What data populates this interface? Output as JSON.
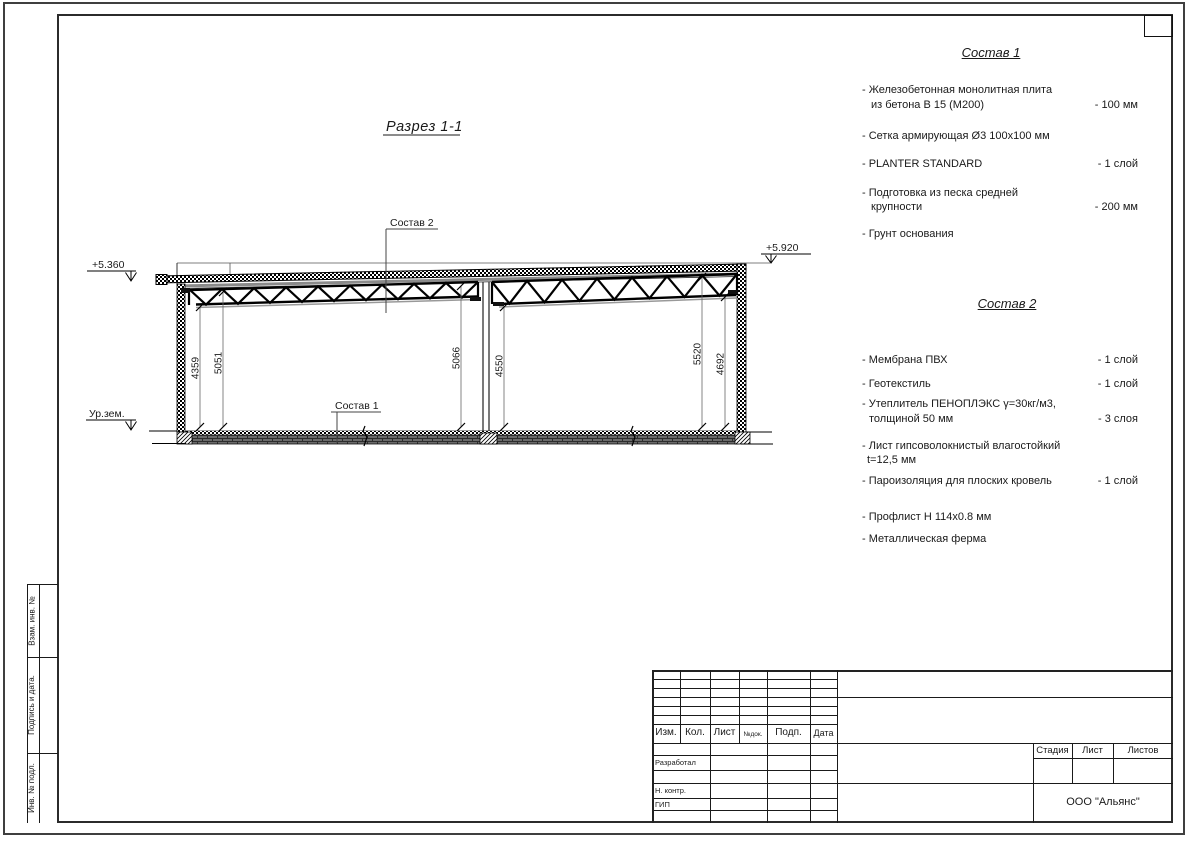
{
  "sheet": {
    "section_title": "Разрез 1-1"
  },
  "drawing": {
    "elev_left": "+5.360",
    "elev_right": "+5.920",
    "ground_label": "Ур.зем.",
    "callout_top": "Состав 2",
    "callout_bottom": "Состав 1",
    "dims": {
      "d1": "4359",
      "d2": "5051",
      "d3": "5066",
      "d4": "4550",
      "d5": "5520",
      "d6": "4692"
    }
  },
  "sostav1": {
    "heading": "Состав 1",
    "items": [
      {
        "l1": "- Железобетонная  монолитная плита",
        "l2": "из бетона В 15 (М200)",
        "val": "- 100 мм"
      },
      {
        "l1": "- Сетка армирующая Ø3 100х100 мм",
        "l2": "",
        "val": ""
      },
      {
        "l1": "- PLANTER STANDARD",
        "l2": "",
        "val": "- 1  слой"
      },
      {
        "l1": "- Подготовка из песка средней",
        "l2": "крупности",
        "val": "- 200 мм"
      },
      {
        "l1": "- Грунт основания",
        "l2": "",
        "val": ""
      }
    ]
  },
  "sostav2": {
    "heading": "Состав 2",
    "items": [
      {
        "l1": "- Мембрана ПВХ",
        "l2": "",
        "val": "- 1 слой"
      },
      {
        "l1": "- Геотекстиль",
        "l2": "",
        "val": "- 1 слой"
      },
      {
        "l1": "- Утеплитель ПЕНОПЛЭКС γ=30кг/м3,",
        "l2": "толщиной 50 мм",
        "val": "- 3 слоя"
      },
      {
        "l1": "- Лист гипсоволокнистый влагостойкий",
        "l2": "t=12,5 мм",
        "val": ""
      },
      {
        "l1": "- Пароизоляция для плоских кровель",
        "l2": "",
        "val": "- 1 слой"
      },
      {
        "l1": "- Профлист Н 114х0.8 мм",
        "l2": "",
        "val": ""
      },
      {
        "l1": "- Металлическая ферма",
        "l2": "",
        "val": ""
      }
    ]
  },
  "stamp": {
    "col_izm": "Изм.",
    "col_kol": "Кол.",
    "col_list": "Лист",
    "col_ndok": "№док.",
    "col_podp": "Подп.",
    "col_data": "Дата",
    "row_razrabotal": "Разработал",
    "row_nkontr": "Н. контр.",
    "row_gip": "ГИП",
    "stage": "Стадия",
    "list": "Лист",
    "listov": "Листов",
    "company": "ООО \"Альянс\""
  },
  "side": {
    "vzam": "Взам. инв. №",
    "podpis": "Подпись  и  дата.",
    "inv": "Инв. № подл."
  }
}
